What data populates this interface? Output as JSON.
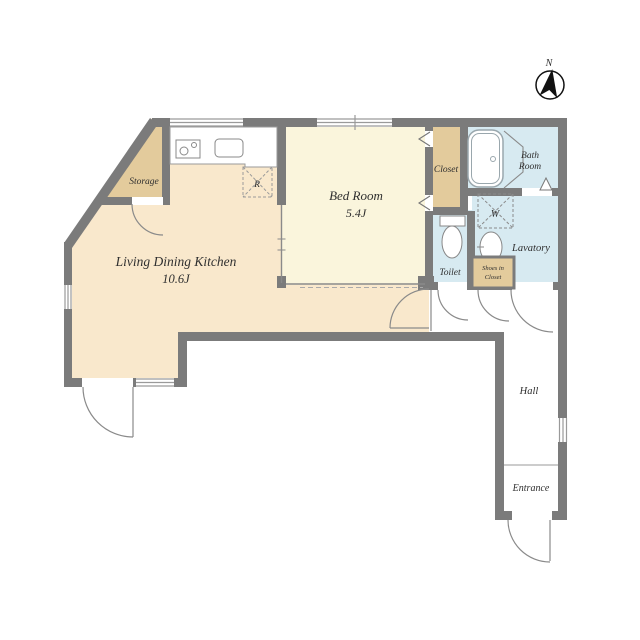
{
  "compass": {
    "north": "N"
  },
  "rooms": {
    "ldk": {
      "name": "Living Dining Kitchen",
      "size": "10.6J"
    },
    "bedroom": {
      "name": "Bed Room",
      "size": "5.4J"
    },
    "storage": {
      "name": "Storage"
    },
    "closet": {
      "name": "Closet"
    },
    "bathroom": {
      "line1": "Bath",
      "line2": "Room"
    },
    "toilet": {
      "name": "Toilet"
    },
    "lavatory": {
      "name": "Lavatory"
    },
    "hall": {
      "name": "Hall"
    },
    "entrance": {
      "name": "Entrance"
    },
    "shoes_closet": {
      "line1": "Shoes in",
      "line2": "Closet"
    }
  },
  "fixtures": {
    "refrigerator": "R",
    "washing_machine": "W"
  },
  "colors": {
    "wall": "#7b7b7b",
    "ldk": "#f9e8cc",
    "bedroom": "#faf5dc",
    "tan": "#e3cb9c",
    "water": "#d7eaf1",
    "white": "#ffffff",
    "line": "#8a8a8a",
    "fixture": "#8f9aa0"
  }
}
